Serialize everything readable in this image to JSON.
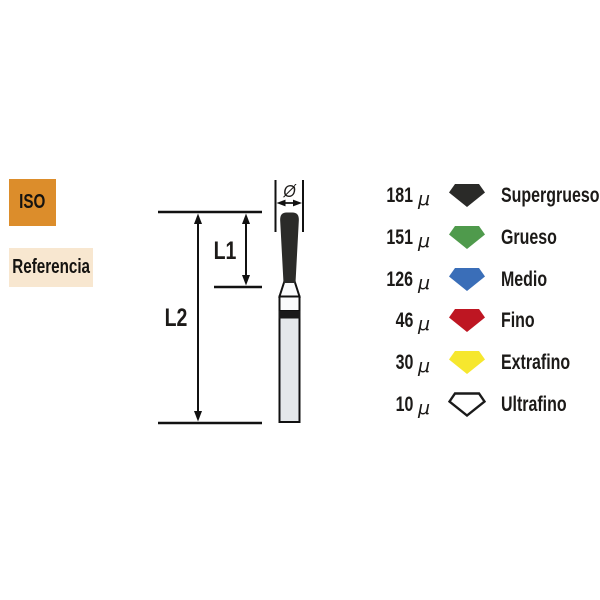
{
  "left_labels": {
    "iso": {
      "text": "ISO",
      "bg": "#DC8D2B"
    },
    "referencia": {
      "text": "Referencia",
      "bg": "#F8E7D0"
    }
  },
  "diagram": {
    "labels": {
      "l1": "L1",
      "l2": "L2",
      "diameter": "Ø"
    },
    "bur": {
      "head_color": "#2B2B29",
      "band_color": "#1A1A1A",
      "collar_color": "#FAFBFC",
      "shaft_color": "#E4E8EA",
      "outline_color": "#111111"
    }
  },
  "legend": {
    "items": [
      {
        "value": "181",
        "unit": "μ",
        "color": "#2A2A28",
        "stroke": "none",
        "label": "Supergrueso"
      },
      {
        "value": "151",
        "unit": "μ",
        "color": "#4F9A4C",
        "stroke": "none",
        "label": "Grueso"
      },
      {
        "value": "126",
        "unit": "μ",
        "color": "#3A6EB8",
        "stroke": "none",
        "label": "Medio"
      },
      {
        "value": "46",
        "unit": "μ",
        "color": "#BE1622",
        "stroke": "none",
        "label": "Fino"
      },
      {
        "value": "30",
        "unit": "μ",
        "color": "#F6E72E",
        "stroke": "none",
        "label": "Extrafino"
      },
      {
        "value": "10",
        "unit": "μ",
        "color": "#FFFFFF",
        "stroke": "#1A1A1A",
        "label": "Ultrafino"
      }
    ]
  }
}
